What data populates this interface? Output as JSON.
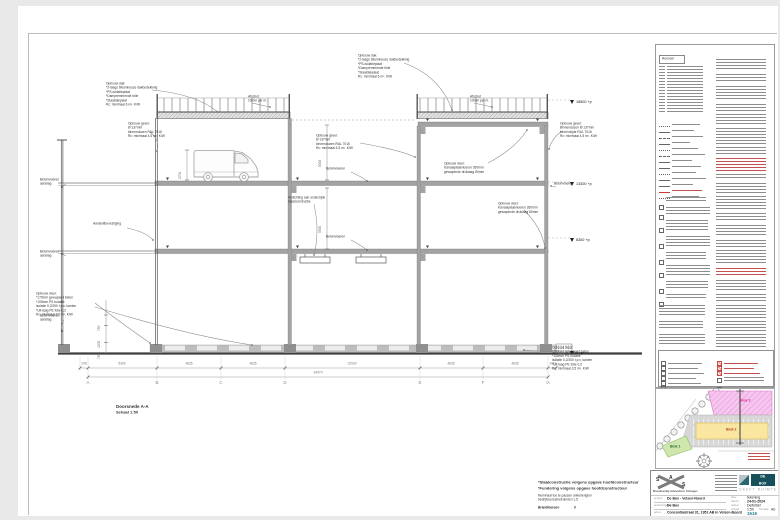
{
  "section": {
    "title": "Doorsnede A-A",
    "scale": "Schaal 1:50",
    "levels": [
      {
        "value": "18500 +p"
      },
      {
        "value": "13300 +p"
      },
      {
        "value": "8300 +p"
      },
      {
        "value": "0 +p"
      }
    ],
    "grid_letters": [
      "A",
      "B",
      "C",
      "D",
      "E",
      "F",
      "G"
    ],
    "dims": [
      "108",
      "5300",
      "4835",
      "4835",
      "10530",
      "4835",
      "4835",
      "108"
    ],
    "dim_total": "34070",
    "vdims": {
      "van": "2704",
      "storey_upper": "5000",
      "storey_lower": "5000",
      "found_top": "750",
      "found_mid": "1200",
      "found_bot": "750"
    },
    "annotations": [
      {
        "text": "Opbouw dak:\n*2-laags bitumineuze dakbedekking\n*PS-isolatieplaat\n*Dampremmende folie\n*Staaldakplaat\nRc: minimaal 6 m². K/W"
      },
      {
        "text": "Opbouw dak:\n*2-laags bitumineuze dakbedekking\n*PS-isolatieplaat\n*Dampremmende folie\n*Staaldakplaat\nRc: minimaal 6 m². K/W"
      },
      {
        "text": "Afschot\n10mm per m."
      },
      {
        "text": "Afschot\n10mm per m."
      },
      {
        "text": "Opbouw gevel:\nØ 137mm\nbinnendozen RAL 7016\nRc: minimaal 4,5 m². K/W"
      },
      {
        "text": "Opbouw gevel:\nØ 137mm\nbinnendozen RAL 7016\nRc: minimaal 4,5 m². K/W"
      },
      {
        "text": "Opbouw gevel:\nBinnendozen Ø 137mm\nbinnenzijde RAL 7016\nRc: minimaal 4,5 m². K/W"
      },
      {
        "text": "Opbouw vloer:\nKanaalplaatvloeren 260mm\ngewapende druklaag 80mm"
      },
      {
        "text": "Betonvloeren"
      },
      {
        "text": "Betonvloeren"
      },
      {
        "text": "Betonvloeren\naanslag"
      },
      {
        "text": "Betonvloeren\naanslag"
      },
      {
        "text": "Aansluitbevestiging"
      },
      {
        "text": "Verlichting aan onderzijde\nstaalconstructie"
      },
      {
        "text": "Opbouw vloer:\nKanaalplaatvloeren 260mm\ngewapende druklaag 80mm"
      },
      {
        "text": "Opbouw vloer:\n*170mm gewapend beton\n*100mm PS-isolatie\nisolatie 0,2/200 t.p.v. kanten\n*Uit-laag PE folie 0,2\nRc: minimaal 3,5 m². K/W"
      },
      {
        "text": "Opbouw vloer:\n*200mm gewapend beton\n*100mm PS-isolatie\nisolatie 0,2/200 t.p.v. kanten\n*Uit-laag PE folie 0,2\nRc: minimaal 3,5 m². K/W"
      },
      {
        "text": "Betonvloeren"
      },
      {
        "text": "Betonvloeren\naanslag"
      }
    ]
  },
  "legend": {
    "title": "Renvooi",
    "right_paragraphs": [
      12,
      9,
      15,
      7,
      11,
      16,
      8,
      13,
      6,
      10,
      14,
      9,
      12,
      7,
      15,
      9,
      11,
      8,
      13,
      10,
      16,
      9
    ]
  },
  "siteplan": {
    "blocks": [
      {
        "label": "Blok 1",
        "color": "#cfe7ad"
      },
      {
        "label": "Blok 2",
        "color": "#f9e6a0"
      },
      {
        "label": "Blok 3",
        "color": "#f5c6ee"
      }
    ]
  },
  "titleblock": {
    "logo_letters": [
      "S",
      "A",
      "S"
    ],
    "firm_name": "Bouwkundig Adviesburo Schagen",
    "brand_line1": "DE",
    "brand_line2": "BOX",
    "brand_tagline": "GEEFT RUIMTE",
    "project_label": "project:",
    "project_value": "De Box - Velsen-Noord",
    "client_label": "opdrachtgever:",
    "client_value": "De Box",
    "address_label": "adres:",
    "address_value": "Concordiastraat 31, 1951 AB in Velsen-Noord",
    "phase_label": "fase:",
    "phase_value": "tekening",
    "date_label": "datum:",
    "date_value": "24-01-2024",
    "status_label": "status:",
    "status_value": "Definitief",
    "scale_label": "schaal:",
    "scale_value": "1:50",
    "format_label": "formaat:",
    "format_value": "A0",
    "sheet_label": "werknr:",
    "sheet_value": "1516"
  },
  "notes": {
    "line1": "*Staalconstructie volgens opgave hoofdconstructeur",
    "line2": "*Fundering volgens opgave hoofdconstructeur",
    "line3": "Nominaal toe te passen ankerlengten",
    "line4": "bedrijfsverzamelruimten 1,5",
    "line5_label": "Brandklassen",
    "line5_value": "0"
  }
}
